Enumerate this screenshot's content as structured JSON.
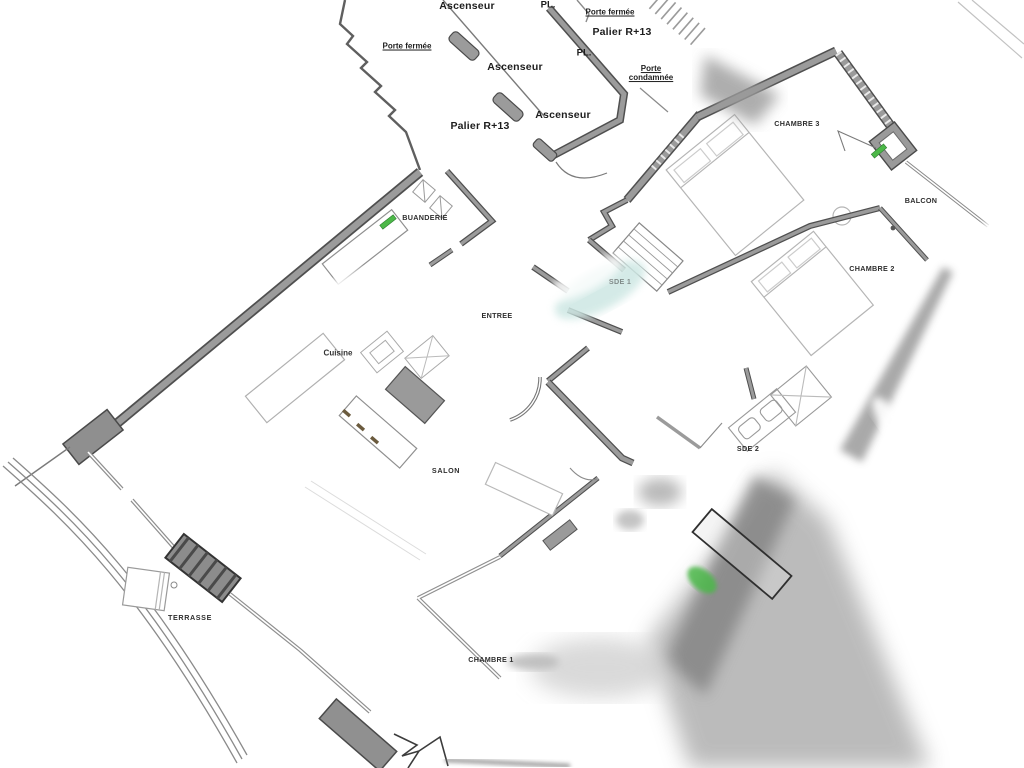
{
  "plan_title": "Plan d'appartement Palier R+13",
  "colors": {
    "accent_green": "#4cb848",
    "wall_gray": "#9b9b9b",
    "wall_edge": "#4f4f4f",
    "teal_smudge": "#cde7e3"
  },
  "landing": {
    "labels": [
      {
        "id": "ascenseur-top",
        "text": "Ascenseur"
      },
      {
        "id": "pl-top",
        "text": "PL."
      },
      {
        "id": "porte-fermee-right",
        "text": "Porte fermée"
      },
      {
        "id": "palier-right",
        "text": "Palier R+13"
      },
      {
        "id": "pl-mid",
        "text": "PL."
      },
      {
        "id": "ascenseur-mid",
        "text": "Ascenseur"
      },
      {
        "id": "porte-condamnee",
        "text": "Porte condamnée"
      },
      {
        "id": "ascenseur-bottom",
        "text": "Ascenseur"
      },
      {
        "id": "palier-left",
        "text": "Palier R+13"
      },
      {
        "id": "porte-fermee-left",
        "text": "Porte fermée"
      }
    ]
  },
  "rooms": {
    "labels": [
      {
        "id": "buanderie",
        "text": "BUANDERIE"
      },
      {
        "id": "entree",
        "text": "ENTREE"
      },
      {
        "id": "sde1",
        "text": "SDE 1"
      },
      {
        "id": "cuisine",
        "text": "Cuisine"
      },
      {
        "id": "salon",
        "text": "SALON"
      },
      {
        "id": "chambre1",
        "text": "CHAMBRE 1"
      },
      {
        "id": "terrasse",
        "text": "TERRASSE"
      },
      {
        "id": "sde2",
        "text": "SDE 2"
      },
      {
        "id": "chambre2",
        "text": "CHAMBRE 2"
      },
      {
        "id": "chambre3",
        "text": "CHAMBRE 3"
      },
      {
        "id": "balcon",
        "text": "BALCON"
      }
    ]
  }
}
